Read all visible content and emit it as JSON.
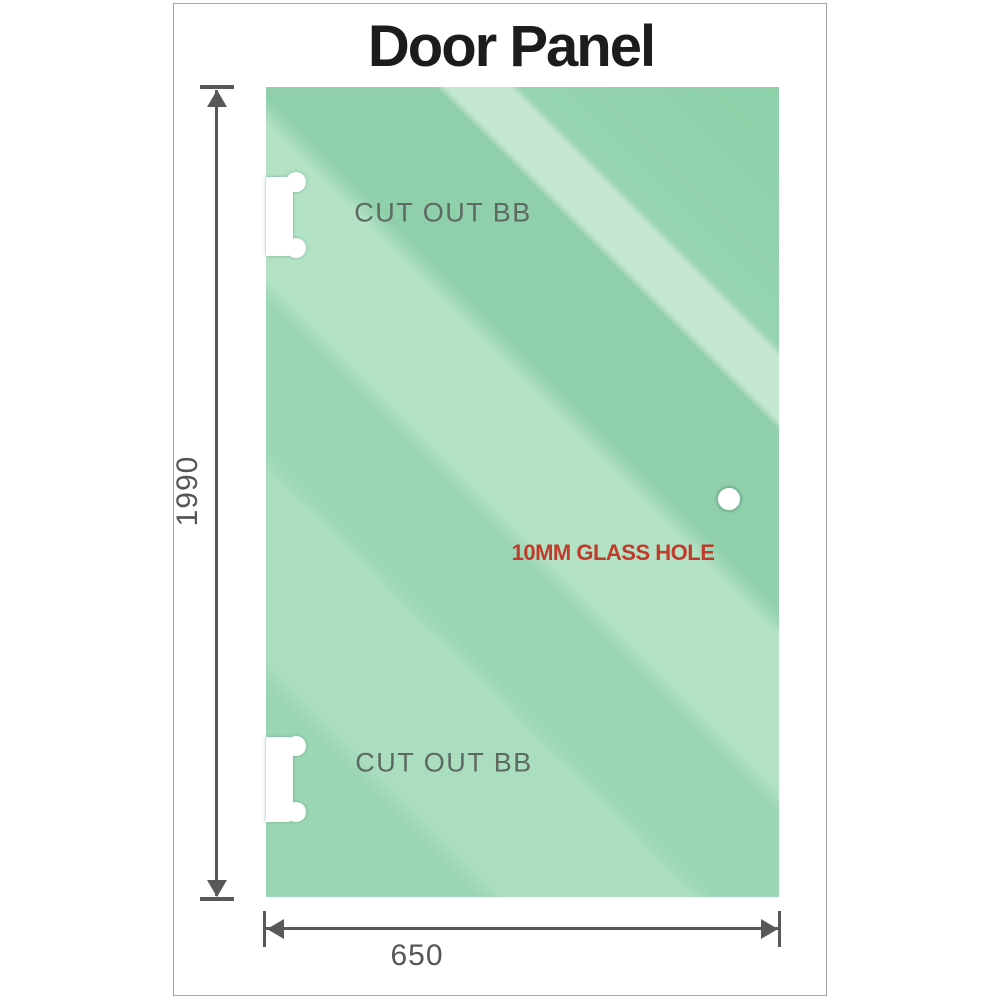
{
  "title": "Door Panel",
  "panel": {
    "labels": {
      "cutout_top": "CUT OUT BB",
      "cutout_bottom": "CUT OUT BB",
      "glass_hole": "10MM GLASS HOLE"
    },
    "dimensions": {
      "height_mm": "1990",
      "width_mm": "650"
    }
  },
  "colors": {
    "glass_green_base": "#9bd6b4",
    "glass_green_light": "#b3e2c5",
    "glass_green_lightest": "#c4e8d1",
    "glass_green_dark": "#8fd0aa",
    "dimension_gray": "#57585a",
    "annotation_red": "#c13a2c",
    "cutout_label_gray": "#5d6962",
    "frame_border_gray": "#a5a5a5",
    "title_black": "#1e1b1c"
  }
}
